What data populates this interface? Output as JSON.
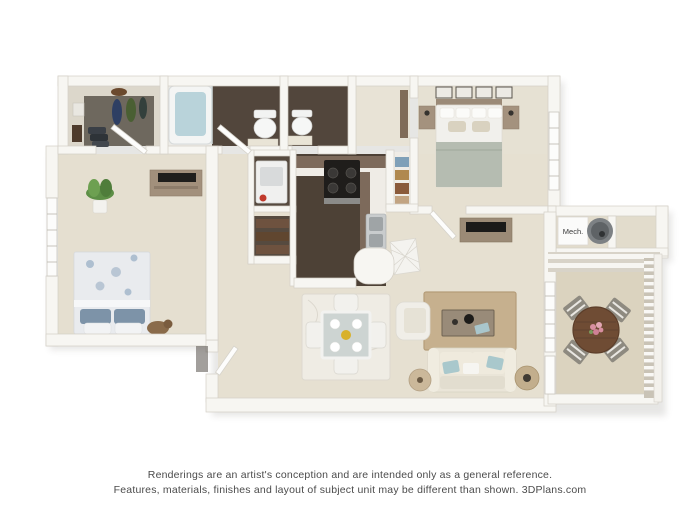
{
  "page": {
    "background": "#ffffff"
  },
  "floor_plan": {
    "type": "3d-floor-plan-rendering",
    "mech_label": "Mech.",
    "disclaimer_line1": "Renderings are an artist's conception and are intended only as a general reference.",
    "disclaimer_line2": "Features, materials, finishes and layout of subject unit may be different than shown. 3DPlans.com"
  },
  "palette": {
    "wall": "#f7f6f2",
    "wall_edge": "#d3cfc7",
    "carpet_beige": "#e6e0d1",
    "dark_wood_floor": "#4d4136",
    "closet_carpet": "#6e685e",
    "patio_floor": "#dbd3bf",
    "counter_top_brown": "#7d6a5b",
    "sofa_cream": "#eae5d8",
    "accent_aqua_pillow": "#a9c8cc",
    "living_rug_tan": "#c6b08e",
    "bed_blanket_sage": "#b5bcb1",
    "bedroom2_pillow_slate": "#7d93a8",
    "patio_table_wood": "#6f4c34",
    "water_heater_gray": "#7d8184",
    "tub_water_blue": "#b9d3da",
    "detergent_red": "#c0392b",
    "disclaimer_text": "#4b4b4b"
  }
}
